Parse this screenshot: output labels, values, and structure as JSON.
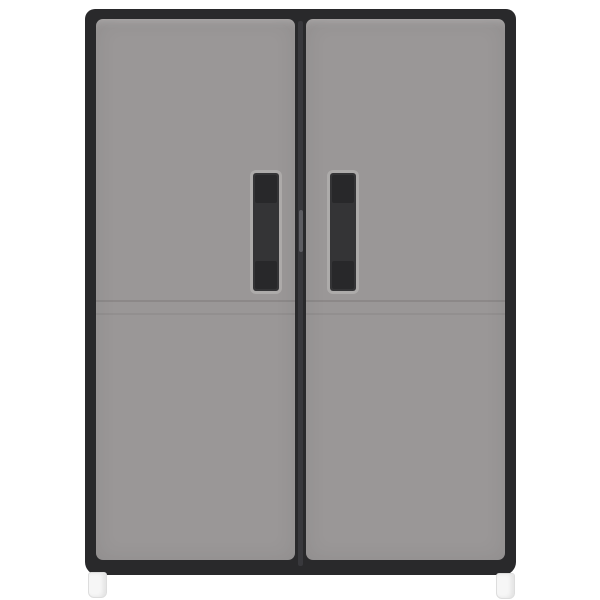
{
  "page": {
    "background_color": "#ffffff"
  },
  "product": {
    "kind": "fabric-wardrobe-two-doors",
    "doors_count": 2,
    "handles_count": 2,
    "feet_count": 2,
    "colors": {
      "fabric_grey": "#9a9797",
      "trim_black": "#29292b",
      "handle_black": "#343436",
      "handle_stitch": "#1f1f21",
      "zipper_track": "#3a3a3e",
      "zipper_pull": "#5d5d62",
      "seam_dark": "rgba(70,64,64,0.16)",
      "seam_light": "rgba(70,64,64,0.09)",
      "foot_white": "#f6f6f6",
      "foot_border": "#dddddd"
    }
  }
}
